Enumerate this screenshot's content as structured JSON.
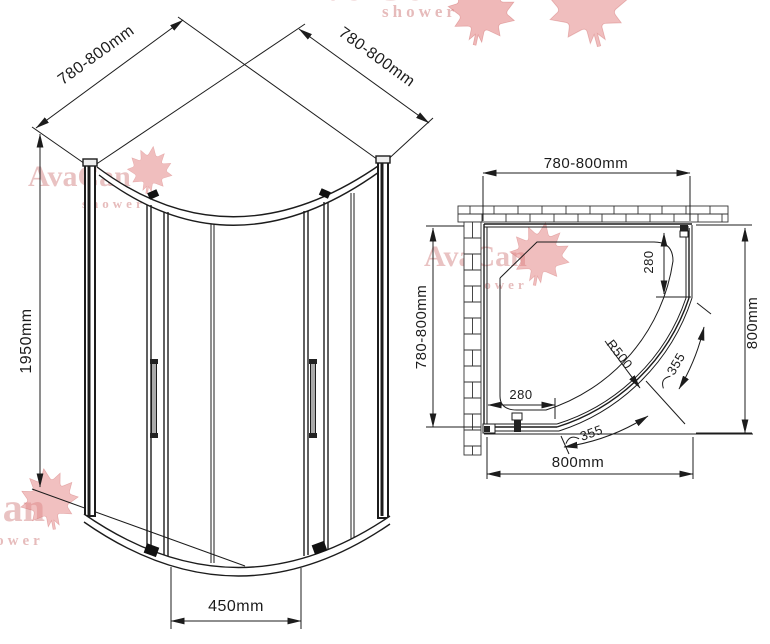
{
  "drawing": {
    "iso_view": {
      "width_left": "780-800mm",
      "width_right": "780-800mm",
      "height": "1950mm",
      "door_opening": "450mm"
    },
    "plan_view": {
      "width_top": "780-800mm",
      "depth_left": "780-800mm",
      "depth_right": "800mm",
      "width_bottom": "800mm",
      "fixed_panel_right": "280",
      "fixed_panel_bottom": "280",
      "radius": "R500",
      "arc_door_top": "355",
      "arc_door_bottom": "355"
    },
    "line_color": "#1c1c1c"
  },
  "watermark": {
    "brand": "AvaCan",
    "subtitle": "shower",
    "text_color": "#ca6e6e",
    "leaf_color": "#e28282"
  }
}
